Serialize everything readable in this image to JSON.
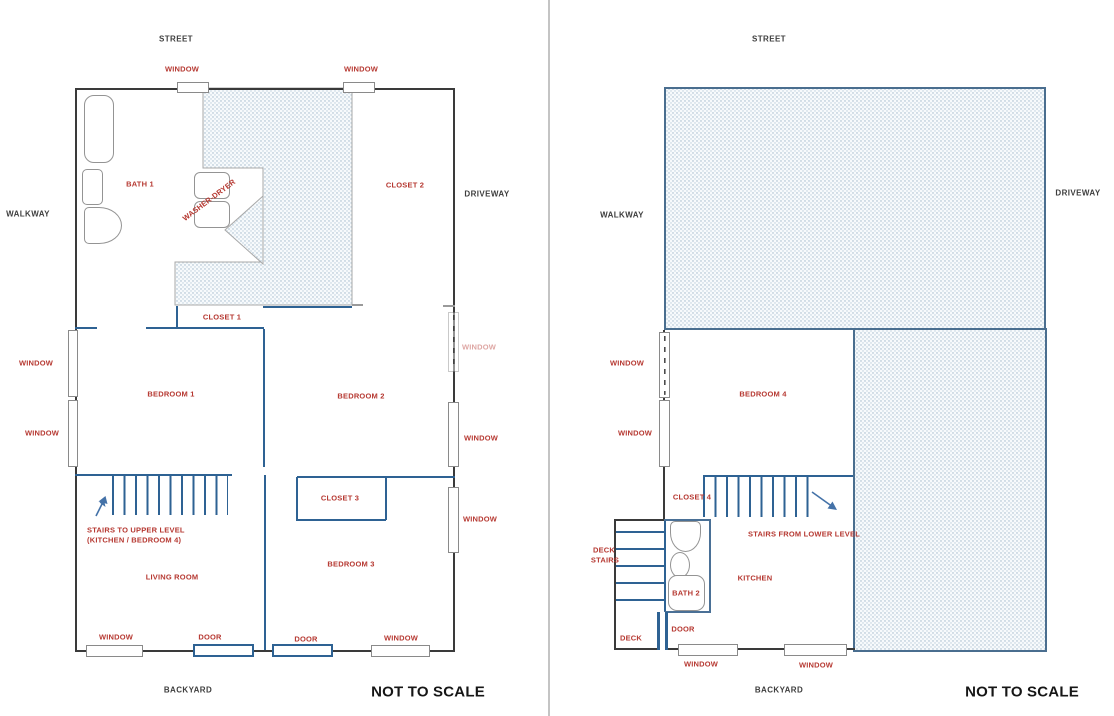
{
  "colors": {
    "label_red": "#b63831",
    "wall_blue": "#2e6293",
    "wall_black": "#3a3a3a",
    "hatch_dot": "#9fb6c9",
    "hatch_border_left": "#a9a9a9",
    "hatch_border_right": "#4a6e8f",
    "outside_text": "#3d3d3d",
    "window_border": "#8a8a8a"
  },
  "shared": {
    "window": "WINDOW",
    "door": "DOOR",
    "street": "STREET",
    "walkway": "WALKWAY",
    "driveway": "DRIVEWAY",
    "backyard": "BACKYARD",
    "not_to_scale": "NOT TO SCALE"
  },
  "left_plan": {
    "rooms": {
      "bath1": "BATH 1",
      "washer_dryer": "WASHER-DRYER",
      "closet1": "CLOSET 1",
      "closet2": "CLOSET 2",
      "closet3": "CLOSET 3",
      "bedroom1": "BEDROOM 1",
      "bedroom2": "BEDROOM 2",
      "bedroom3": "BEDROOM 3",
      "living_room": "LIVING ROOM"
    },
    "stairs_note": {
      "line1": "STAIRS TO UPPER LEVEL",
      "line2": "(KITCHEN / BEDROOM 4)"
    }
  },
  "right_plan": {
    "rooms": {
      "bedroom4": "BEDROOM 4",
      "closet4": "CLOSET 4",
      "kitchen": "KITCHEN",
      "bath2": "BATH 2",
      "deck": "DECK"
    },
    "deck_stairs": {
      "line1": "DECK",
      "line2": "STAIRS"
    },
    "stairs_note": "STAIRS FROM LOWER LEVEL"
  }
}
